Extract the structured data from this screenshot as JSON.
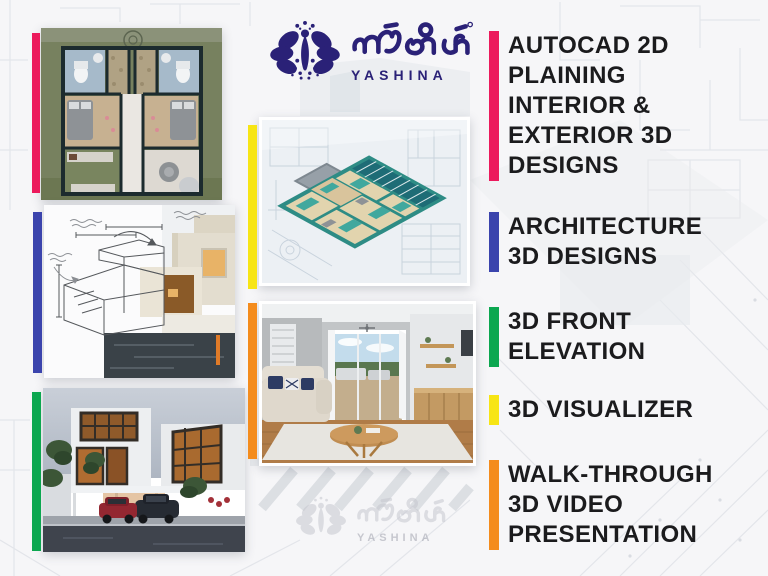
{
  "brand": {
    "kannada_wordmark": "ಯಶಿನ",
    "latin_wordmark": "YASHINA",
    "logo_color": "#2A2177"
  },
  "colors": {
    "background": "#F6F6F8",
    "text": "#1B1B1D",
    "pink": "#EC1A5C",
    "indigo": "#3B44AD",
    "green": "#0CA750",
    "yellow": "#F7E515",
    "orange": "#F48C1D"
  },
  "services": [
    {
      "label": "AUTOCAD 2D PLAINING INTERIOR & EXTERIOR 3D DESIGNS",
      "lines": [
        "AUTOCAD 2D",
        "PLAINING",
        "INTERIOR &",
        "EXTERIOR 3D",
        "DESIGNS"
      ],
      "accent": "#EC1A5C"
    },
    {
      "label": "ARCHITECTURE 3D DESIGNS",
      "lines": [
        "ARCHITECTURE",
        "3D DESIGNS"
      ],
      "accent": "#3B44AD"
    },
    {
      "label": "3D FRONT ELEVATION",
      "lines": [
        "3D FRONT",
        "ELEVATION"
      ],
      "accent": "#0CA750"
    },
    {
      "label": "3D VISUALIZER",
      "lines": [
        "3D VISUALIZER"
      ],
      "accent": "#F7E515"
    },
    {
      "label": "WALK-THROUGH 3D VIDEO PRESENTATION",
      "lines": [
        "WALK-THROUGH",
        "3D VIDEO",
        "PRESENTATION"
      ],
      "accent": "#F48C1D"
    }
  ],
  "gallery": [
    {
      "name": "2d-floor-plan-render",
      "accent": "#EC1A5C"
    },
    {
      "name": "sketch-to-render-house",
      "accent": "#3B44AD"
    },
    {
      "name": "exterior-night-render",
      "accent": "#0CA750"
    },
    {
      "name": "isometric-3d-floor-plan",
      "accent": "#F7E515"
    },
    {
      "name": "interior-living-room-render",
      "accent": "#F48C1D"
    }
  ]
}
